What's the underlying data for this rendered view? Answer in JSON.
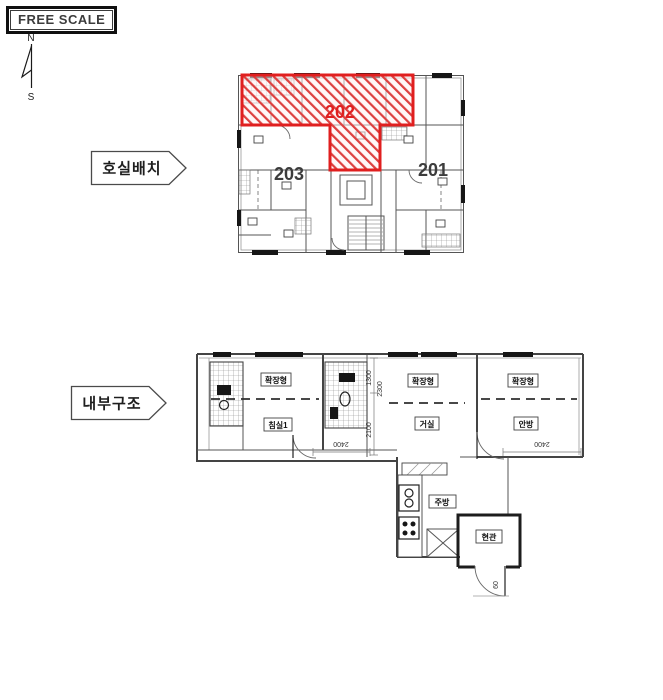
{
  "colors": {
    "highlight": "#e02020",
    "line": "#555555"
  },
  "scale_box": {
    "label": "FREE SCALE"
  },
  "compass": {
    "north": "N",
    "south": "S"
  },
  "unit_plan": {
    "section_label": "호실배치",
    "highlighted_unit": "202",
    "units": {
      "u202": "202",
      "u203": "203",
      "u201": "201"
    }
  },
  "interior_plan": {
    "section_label": "내부구조",
    "rooms": {
      "ext_left": "확장형",
      "bed1": "침실1",
      "ext_mid": "확장형",
      "living": "거실",
      "ext_right": "확장형",
      "master": "안방",
      "kitchen": "주방",
      "entrance": "현관"
    },
    "dimensions": {
      "v1": "1300",
      "v2": "2300",
      "v3": "2100",
      "h1": "2400",
      "h2": "2400",
      "door": "60"
    }
  }
}
